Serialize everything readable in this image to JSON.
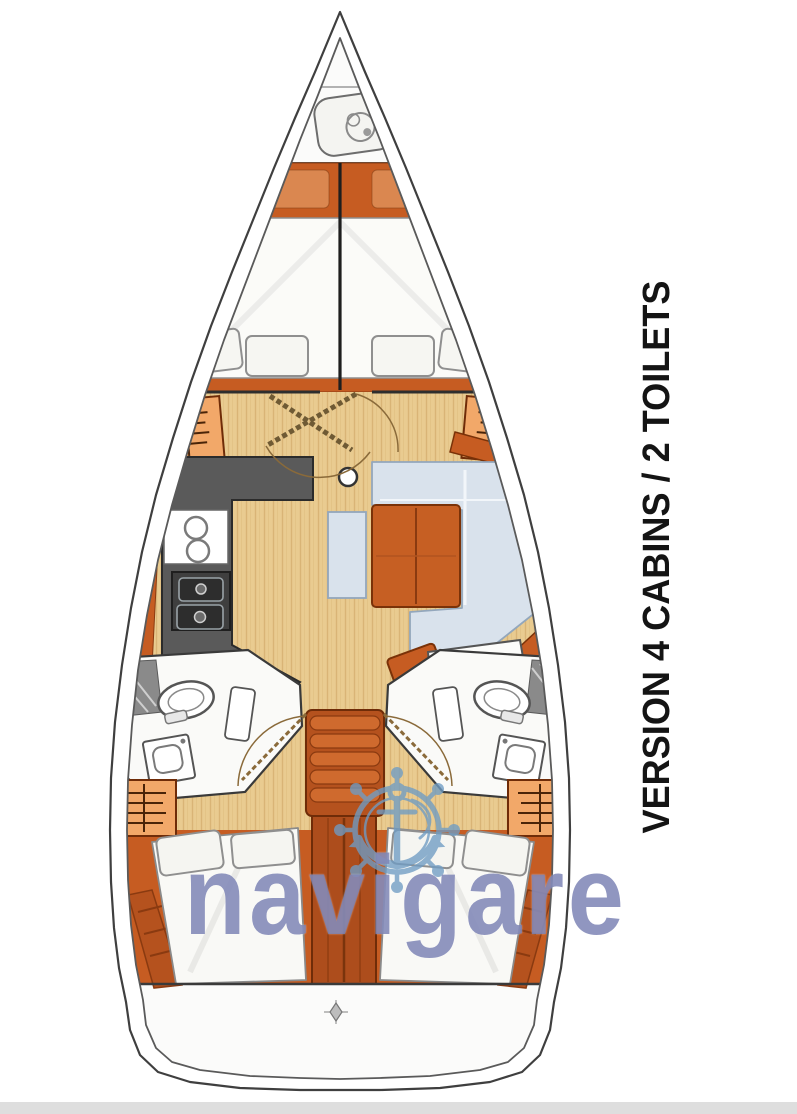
{
  "title": {
    "text": "VERSION 4 CABINS / 2 TOILETS"
  },
  "watermark": {
    "text": "navigare",
    "logo_icon": "ship-wheel-anchor-icon",
    "text_color": "#7b82b4",
    "logo_color": "#6f9cc4"
  },
  "plan": {
    "subject": "sailboat-interior-deck-plan",
    "colors": {
      "hull_outline": "#3f3f3f",
      "wood_trim": "#c65c22",
      "wood_dark": "#a9481a",
      "wood_floor": "#e9cb90",
      "wardrobe": "#f2a869",
      "galley_counter": "#5a5a5a",
      "seat_cushion": "#d9e2ec",
      "mattress": "#faf9f7",
      "title_text": "#141414"
    },
    "icons": [
      "anchor-windlass-icon",
      "clothes-hanger-icon",
      "galley-sink-icon",
      "stove-burners-icon",
      "toilet-icon",
      "washbasin-icon",
      "shower-mat-icon",
      "mast-post-icon",
      "companionway-stairs-icon",
      "compass-rose-icon",
      "ship-wheel-anchor-icon"
    ]
  }
}
